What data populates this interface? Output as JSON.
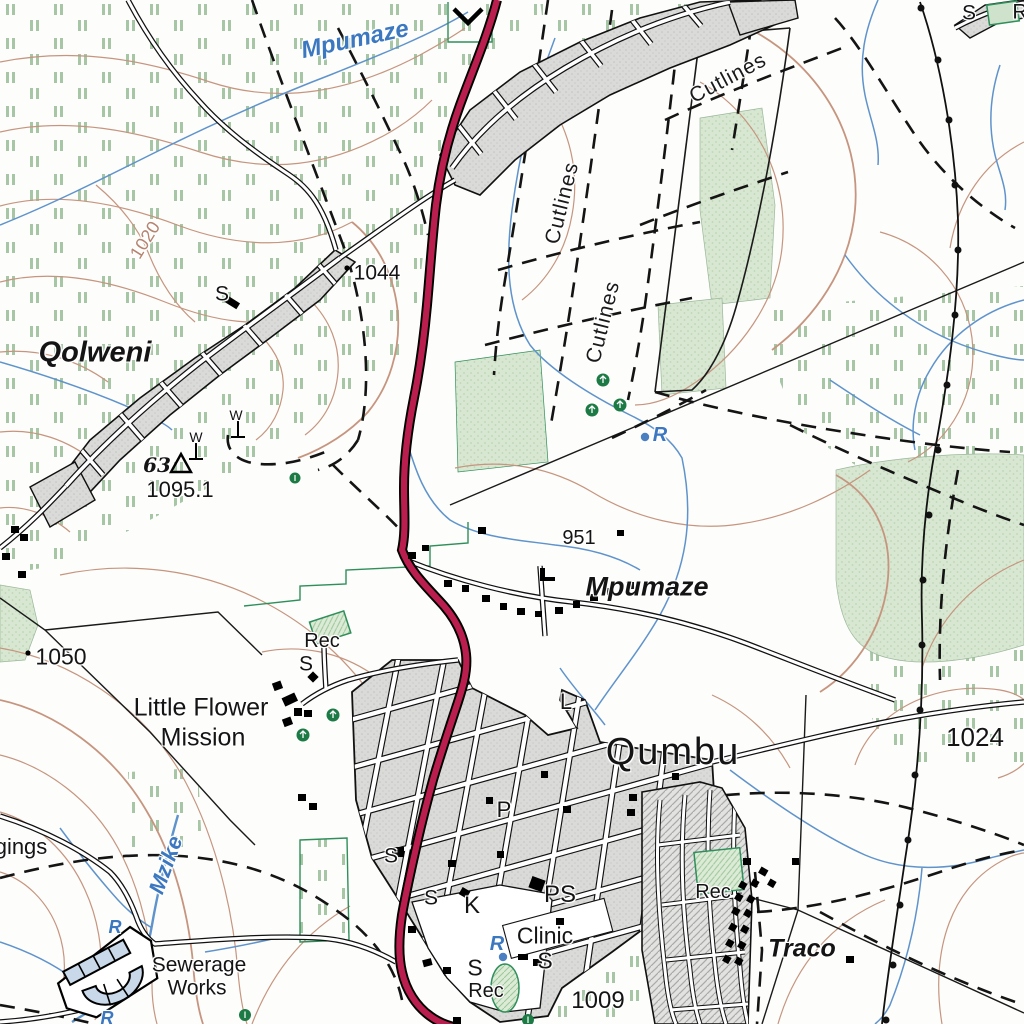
{
  "map": {
    "type": "topographic-map",
    "colors": {
      "main_road": "#b91e4f",
      "road_casing": "#000000",
      "contour": "#c6957f",
      "water": "#5f93cc",
      "water_label": "#3c78c0",
      "cultivation_mark": "#a6c6a6",
      "woodland_fill": "#d5e6cf",
      "builtup_fill": "#d9d9d7",
      "recreation_green": "#2f8f5b",
      "tree_green": "#1c7a45"
    },
    "symbols": [
      {
        "name": "trig-beacon",
        "x": 181,
        "y": 464,
        "value": "1095.1",
        "number": "63"
      },
      {
        "name": "dam-weir",
        "x": 468,
        "y": 14
      },
      {
        "name": "windpump",
        "x": 196,
        "y": 452
      },
      {
        "name": "windpump",
        "x": 238,
        "y": 431
      },
      {
        "name": "reservoir-dot",
        "x": 645,
        "y": 437
      },
      {
        "name": "reservoir-dot",
        "x": 503,
        "y": 957
      },
      {
        "name": "spot-height-dot",
        "x": 347,
        "y": 268
      },
      {
        "name": "spot-height-dot",
        "x": 28,
        "y": 653
      },
      {
        "name": "power-line",
        "from": [
          920,
          2
        ],
        "to": [
          882,
          1024
        ]
      },
      {
        "name": "sewerage-works-plant",
        "x": 108,
        "y": 975
      }
    ]
  },
  "labels": [
    {
      "t": "Mpumaze",
      "x": 355,
      "y": 40,
      "s": 24,
      "r": -12,
      "c": "water",
      "n": "label-river-mpumaze"
    },
    {
      "t": "Cutlines",
      "x": 728,
      "y": 78,
      "s": 21,
      "r": -28,
      "c": "cutline",
      "n": "label-cutlines-1"
    },
    {
      "t": "Cutlines",
      "x": 562,
      "y": 203,
      "s": 21,
      "r": -76,
      "c": "cutline",
      "n": "label-cutlines-2"
    },
    {
      "t": "Cutlines",
      "x": 603,
      "y": 322,
      "s": 21,
      "r": -76,
      "c": "cutline",
      "n": "label-cutlines-3"
    },
    {
      "t": "1044",
      "x": 377,
      "y": 273,
      "s": 21,
      "c": "elev",
      "n": "label-spot-1044"
    },
    {
      "t": "1020",
      "x": 145,
      "y": 240,
      "s": 18,
      "r": -58,
      "c": "contour",
      "n": "label-contour-1020"
    },
    {
      "t": "Qolweni",
      "x": 95,
      "y": 353,
      "s": 29,
      "c": "place",
      "n": "label-place-qolweni"
    },
    {
      "t": "S",
      "x": 222,
      "y": 294,
      "s": 21,
      "c": "feature",
      "n": "label-s-qolweni"
    },
    {
      "t": "S",
      "x": 969,
      "y": 13,
      "s": 21,
      "c": "feature",
      "n": "label-s-topright"
    },
    {
      "t": "R",
      "x": 1020,
      "y": 12,
      "s": 21,
      "c": "feature",
      "n": "label-r-topright"
    },
    {
      "t": "W",
      "x": 196,
      "y": 437,
      "s": 14,
      "c": "feature",
      "n": "label-w-1"
    },
    {
      "t": "W",
      "x": 236,
      "y": 415,
      "s": 14,
      "c": "feature",
      "n": "label-w-2"
    },
    {
      "t": "63",
      "x": 157,
      "y": 465,
      "s": 20,
      "c": "trig",
      "n": "label-trig-63"
    },
    {
      "t": "1095.1",
      "x": 180,
      "y": 490,
      "s": 22,
      "c": "elev",
      "n": "label-spot-1095"
    },
    {
      "t": "951",
      "x": 579,
      "y": 538,
      "s": 20,
      "c": "elev",
      "n": "label-spot-951"
    },
    {
      "t": "Mpumaze",
      "x": 647,
      "y": 587,
      "s": 27,
      "c": "place",
      "n": "label-place-mpumaze"
    },
    {
      "t": "1050",
      "x": 61,
      "y": 657,
      "s": 23,
      "c": "elev",
      "n": "label-spot-1050"
    },
    {
      "t": "Rec",
      "x": 322,
      "y": 641,
      "s": 20,
      "c": "feature",
      "n": "label-rec-mission"
    },
    {
      "t": "S",
      "x": 306,
      "y": 664,
      "s": 21,
      "c": "feature",
      "n": "label-s-mission"
    },
    {
      "t": "Little Flower",
      "x": 201,
      "y": 708,
      "s": 25,
      "c": "feature",
      "n": "label-little-flower"
    },
    {
      "t": "Mission",
      "x": 203,
      "y": 738,
      "s": 25,
      "c": "feature",
      "n": "label-mission"
    },
    {
      "t": "L",
      "x": 566,
      "y": 702,
      "s": 22,
      "c": "feature",
      "n": "label-l-qumbu"
    },
    {
      "t": "Qumbu",
      "x": 673,
      "y": 752,
      "s": 38,
      "c": "town",
      "n": "label-town-qumbu"
    },
    {
      "t": "1024",
      "x": 975,
      "y": 737,
      "s": 26,
      "c": "elev",
      "n": "label-spot-1024"
    },
    {
      "t": "P",
      "x": 504,
      "y": 810,
      "s": 22,
      "c": "feature",
      "n": "label-p-qumbu"
    },
    {
      "t": "Mzike",
      "x": 166,
      "y": 865,
      "s": 22,
      "r": -70,
      "c": "water",
      "n": "label-river-mzike"
    },
    {
      "t": "gings",
      "x": 21,
      "y": 847,
      "s": 22,
      "c": "feature",
      "n": "label-gings-partial"
    },
    {
      "t": "S",
      "x": 391,
      "y": 856,
      "s": 21,
      "c": "feature",
      "n": "label-s-qumbu-1"
    },
    {
      "t": "Rec",
      "x": 713,
      "y": 892,
      "s": 20,
      "c": "feature",
      "n": "label-rec-traco"
    },
    {
      "t": "Traco",
      "x": 802,
      "y": 949,
      "s": 25,
      "c": "place",
      "n": "label-place-traco"
    },
    {
      "t": "S",
      "x": 431,
      "y": 898,
      "s": 21,
      "c": "feature",
      "n": "label-s-qumbu-2"
    },
    {
      "t": "PS",
      "x": 560,
      "y": 895,
      "s": 24,
      "c": "feature",
      "n": "label-ps-qumbu"
    },
    {
      "t": "K",
      "x": 472,
      "y": 906,
      "s": 24,
      "c": "feature",
      "n": "label-k-qumbu"
    },
    {
      "t": "Clinic",
      "x": 545,
      "y": 936,
      "s": 23,
      "c": "feature",
      "n": "label-clinic"
    },
    {
      "t": "R",
      "x": 660,
      "y": 435,
      "s": 20,
      "c": "water",
      "n": "label-reservoir-1"
    },
    {
      "t": "R",
      "x": 497,
      "y": 944,
      "s": 20,
      "c": "water",
      "n": "label-reservoir-2"
    },
    {
      "t": "R",
      "x": 115,
      "y": 927,
      "s": 18,
      "c": "water",
      "n": "label-reservoir-3"
    },
    {
      "t": "R",
      "x": 107,
      "y": 1018,
      "s": 18,
      "c": "water",
      "n": "label-reservoir-4"
    },
    {
      "t": "S",
      "x": 475,
      "y": 968,
      "s": 23,
      "c": "feature",
      "n": "label-s-qumbu-3"
    },
    {
      "t": "S",
      "x": 545,
      "y": 961,
      "s": 23,
      "c": "feature",
      "n": "label-s-qumbu-4"
    },
    {
      "t": "Rec",
      "x": 486,
      "y": 991,
      "s": 20,
      "c": "feature",
      "n": "label-rec-qumbu"
    },
    {
      "t": "Sewerage",
      "x": 199,
      "y": 965,
      "s": 21,
      "c": "feature",
      "n": "label-sewerage"
    },
    {
      "t": "Works",
      "x": 197,
      "y": 988,
      "s": 21,
      "c": "feature",
      "n": "label-works"
    },
    {
      "t": "1009",
      "x": 598,
      "y": 1001,
      "s": 24,
      "c": "elev",
      "n": "label-spot-1009"
    }
  ]
}
